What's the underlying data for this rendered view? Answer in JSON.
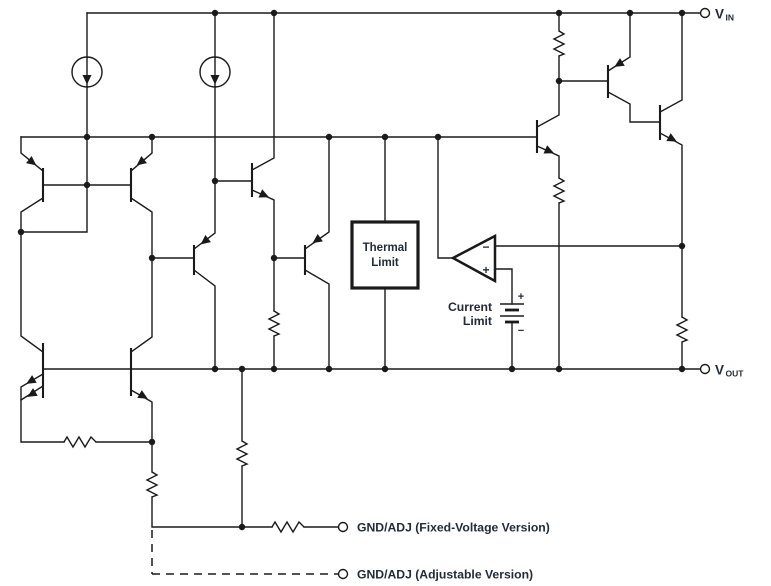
{
  "figure": {
    "colors": {
      "line": "#1a1a1a",
      "text": "#222b38",
      "background": "#ffffff"
    },
    "terminals": {
      "vin": {
        "name": "V",
        "sub": "IN"
      },
      "vout": {
        "name": "V",
        "sub": "OUT"
      },
      "gnd_fixed": {
        "label": "GND/ADJ (Fixed-Voltage Version)"
      },
      "gnd_adjustable": {
        "label": "GND/ADJ (Adjustable Version)"
      }
    },
    "blocks": {
      "thermal_limit": {
        "line1": "Thermal",
        "line2": "Limit"
      },
      "current_limit": {
        "line1": "Current",
        "line2": "Limit"
      }
    },
    "comparator": {
      "inverting": "−",
      "noninverting": "+"
    },
    "battery": {
      "positive": "+",
      "negative": "−"
    }
  }
}
